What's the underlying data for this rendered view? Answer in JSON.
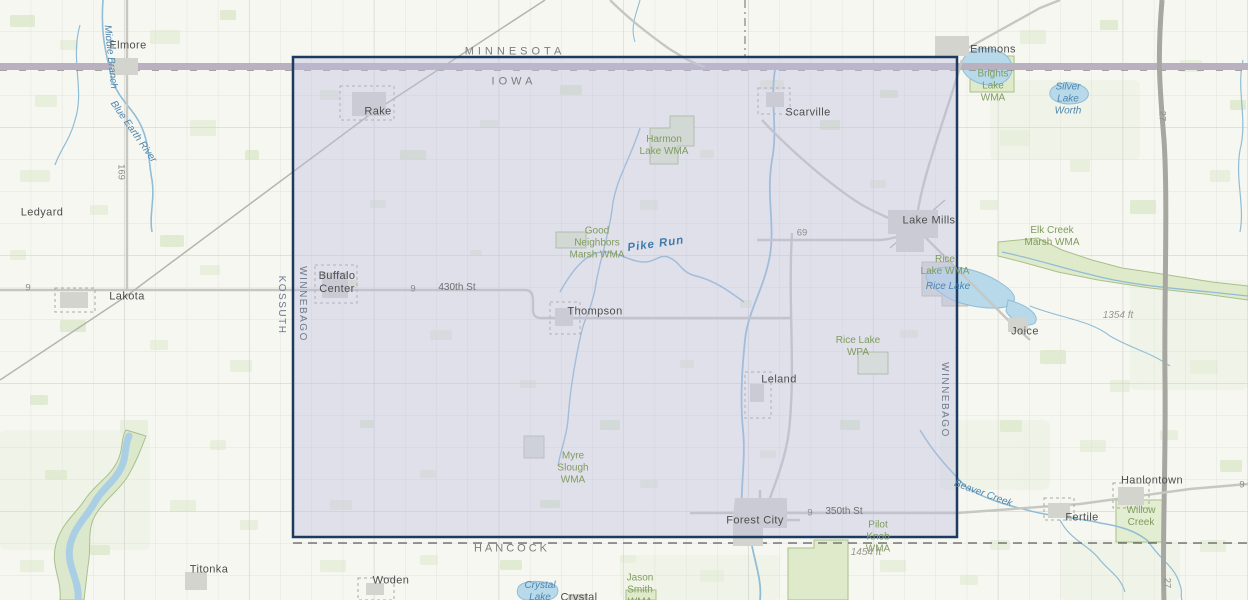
{
  "map": {
    "selection": {
      "x": 293,
      "y": 57,
      "width": 664,
      "height": 480,
      "fill_color": "rgba(190,190,224,0.40)",
      "border_color": "#1d3b60"
    },
    "palette": {
      "base": "#f7f7f2",
      "field": "#e4edd6",
      "water": "#8fbdd6",
      "lake": "#b8d9ea",
      "wma_fill": "#dfeacb",
      "wma_edge": "#a9bf8b",
      "road": "#c9c9c4",
      "highway_band": "#b9b1bf",
      "interstate": "#a7a7a2",
      "town_fill": "#d4d4ce"
    },
    "labels": [
      {
        "name": "state-label-minnesota",
        "text": "MINNESOTA",
        "x": 515,
        "y": 52,
        "type": "state",
        "rot": 0
      },
      {
        "name": "state-label-iowa",
        "text": "IOWA",
        "x": 514,
        "y": 82,
        "type": "state",
        "rot": 0
      },
      {
        "name": "county-label-kossuth",
        "text": "KOSSUTH",
        "x": 281,
        "y": 305,
        "type": "county-v",
        "rot": 90
      },
      {
        "name": "county-label-winnebago-west",
        "text": "WINNEBAGO",
        "x": 302,
        "y": 304,
        "type": "county-v",
        "rot": 90
      },
      {
        "name": "county-label-winnebago-east",
        "text": "WINNEBAGO",
        "x": 944,
        "y": 400,
        "type": "county-v",
        "rot": 90
      },
      {
        "name": "county-label-hancock",
        "text": "HANCOCK",
        "x": 512,
        "y": 549,
        "type": "county",
        "rot": 0
      },
      {
        "name": "town-label-elmore",
        "text": "Elmore",
        "x": 128,
        "y": 46,
        "type": "town",
        "rot": 0
      },
      {
        "name": "town-label-ledyard",
        "text": "Ledyard",
        "x": 42,
        "y": 213,
        "type": "town",
        "rot": 0
      },
      {
        "name": "town-label-lakota",
        "text": "Lakota",
        "x": 127,
        "y": 297,
        "type": "town",
        "rot": 0
      },
      {
        "name": "town-label-rake",
        "text": "Rake",
        "x": 378,
        "y": 112,
        "type": "town",
        "rot": 0
      },
      {
        "name": "town-label-scarville",
        "text": "Scarville",
        "x": 808,
        "y": 113,
        "type": "town",
        "rot": 0
      },
      {
        "name": "town-label-emmons",
        "text": "Emmons",
        "x": 993,
        "y": 50,
        "type": "town",
        "rot": 0
      },
      {
        "name": "town-label-lake-mills",
        "text": "Lake Mills",
        "x": 929,
        "y": 221,
        "type": "town",
        "rot": 0
      },
      {
        "name": "town-label-buffalo-center",
        "text": "Buffalo\nCenter",
        "x": 337,
        "y": 283,
        "type": "town",
        "rot": 0
      },
      {
        "name": "town-label-thompson",
        "text": "Thompson",
        "x": 595,
        "y": 312,
        "type": "town",
        "rot": 0
      },
      {
        "name": "town-label-leland",
        "text": "Leland",
        "x": 779,
        "y": 380,
        "type": "town",
        "rot": 0
      },
      {
        "name": "town-label-joice",
        "text": "Joice",
        "x": 1025,
        "y": 332,
        "type": "town",
        "rot": 0
      },
      {
        "name": "town-label-forest-city",
        "text": "Forest City",
        "x": 755,
        "y": 521,
        "type": "town",
        "rot": 0
      },
      {
        "name": "town-label-hanlontown",
        "text": "Hanlontown",
        "x": 1152,
        "y": 481,
        "type": "town",
        "rot": 0
      },
      {
        "name": "town-label-fertile",
        "text": "Fertile",
        "x": 1082,
        "y": 518,
        "type": "town",
        "rot": 0
      },
      {
        "name": "town-label-titonka",
        "text": "Titonka",
        "x": 209,
        "y": 570,
        "type": "town",
        "rot": 0
      },
      {
        "name": "town-label-woden",
        "text": "Woden",
        "x": 391,
        "y": 581,
        "type": "town",
        "rot": 0
      },
      {
        "name": "town-label-crystal",
        "text": "Crystal",
        "x": 579,
        "y": 598,
        "type": "town",
        "rot": 0
      },
      {
        "name": "water-label-middle-branch",
        "text": "Middle Branch",
        "x": 110,
        "y": 57,
        "type": "water",
        "rot": 84
      },
      {
        "name": "water-label-blue-earth-river",
        "text": "Blue Earth River",
        "x": 133,
        "y": 132,
        "type": "water",
        "rot": 55
      },
      {
        "name": "water-label-pike-run",
        "text": "Pike Run",
        "x": 656,
        "y": 245,
        "type": "water-lg",
        "rot": -8
      },
      {
        "name": "water-label-beaver-creek",
        "text": "Beaver Creek",
        "x": 983,
        "y": 494,
        "type": "water",
        "rot": 20
      },
      {
        "name": "water-label-silver-lake-worth",
        "text": "Silver\nLake\nWorth",
        "x": 1068,
        "y": 99,
        "type": "water",
        "rot": 0
      },
      {
        "name": "water-label-rice-lake",
        "text": "Rice Lake",
        "x": 948,
        "y": 287,
        "type": "water",
        "rot": 0
      },
      {
        "name": "water-label-crystal-lake",
        "text": "Crystal\nLake",
        "x": 540,
        "y": 592,
        "type": "water",
        "rot": 0
      },
      {
        "name": "wma-label-brights-lake",
        "text": "Brights\nLake\nWMA",
        "x": 993,
        "y": 86,
        "type": "wma",
        "rot": 0
      },
      {
        "name": "wma-label-harmon-lake",
        "text": "Harmon\nLake WMA",
        "x": 664,
        "y": 146,
        "type": "wma",
        "rot": 0
      },
      {
        "name": "wma-label-good-neighbors-marsh",
        "text": "Good\nNeighbors\nMarsh WMA",
        "x": 597,
        "y": 243,
        "type": "wma",
        "rot": 0
      },
      {
        "name": "wma-label-elk-creek-marsh",
        "text": "Elk Creek\nMarsh WMA",
        "x": 1052,
        "y": 237,
        "type": "wma",
        "rot": 0
      },
      {
        "name": "wma-label-rice-lake-wma",
        "text": "Rice\nLake WMA",
        "x": 945,
        "y": 266,
        "type": "wma",
        "rot": 0
      },
      {
        "name": "wma-label-rice-lake-wpa",
        "text": "Rice Lake\nWPA",
        "x": 858,
        "y": 347,
        "type": "wma",
        "rot": 0
      },
      {
        "name": "wma-label-myre-slough",
        "text": "Myre\nSlough\nWMA",
        "x": 573,
        "y": 468,
        "type": "wma",
        "rot": 0
      },
      {
        "name": "wma-label-pilot-knob",
        "text": "Pilot\nKnob\nWMA",
        "x": 878,
        "y": 537,
        "type": "wma",
        "rot": 0
      },
      {
        "name": "wma-label-willow-creek",
        "text": "Willow\nCreek",
        "x": 1141,
        "y": 517,
        "type": "wma",
        "rot": 0
      },
      {
        "name": "wma-label-jason-smith",
        "text": "Jason\nSmith\nWMA",
        "x": 640,
        "y": 590,
        "type": "wma",
        "rot": 0
      },
      {
        "name": "road-label-169",
        "text": "169",
        "x": 121,
        "y": 172,
        "type": "road",
        "rot": 90
      },
      {
        "name": "road-label-9-west",
        "text": "9",
        "x": 28,
        "y": 288,
        "type": "road",
        "rot": 0
      },
      {
        "name": "road-label-9-430th",
        "text": "9",
        "x": 413,
        "y": 289,
        "type": "road",
        "rot": 0
      },
      {
        "name": "street-label-430th",
        "text": "430th St",
        "x": 457,
        "y": 288,
        "type": "street",
        "rot": 0
      },
      {
        "name": "road-label-69",
        "text": "69",
        "x": 802,
        "y": 233,
        "type": "road",
        "rot": 0
      },
      {
        "name": "road-label-9-350th",
        "text": "9",
        "x": 810,
        "y": 513,
        "type": "road",
        "rot": 0
      },
      {
        "name": "street-label-350th",
        "text": "350th St",
        "x": 844,
        "y": 512,
        "type": "street",
        "rot": 0
      },
      {
        "name": "road-label-9-east",
        "text": "9",
        "x": 1242,
        "y": 485,
        "type": "road",
        "rot": 0
      },
      {
        "name": "road-label-27-north",
        "text": "27",
        "x": 1162,
        "y": 116,
        "type": "road",
        "rot": 90
      },
      {
        "name": "road-label-27-south",
        "text": "27",
        "x": 1167,
        "y": 583,
        "type": "road",
        "rot": 90
      },
      {
        "name": "elevation-label-1354",
        "text": "1354 ft",
        "x": 1118,
        "y": 316,
        "type": "elev",
        "rot": 0
      },
      {
        "name": "elevation-label-1454",
        "text": "1454 ft",
        "x": 866,
        "y": 553,
        "type": "elev",
        "rot": 0
      }
    ]
  }
}
